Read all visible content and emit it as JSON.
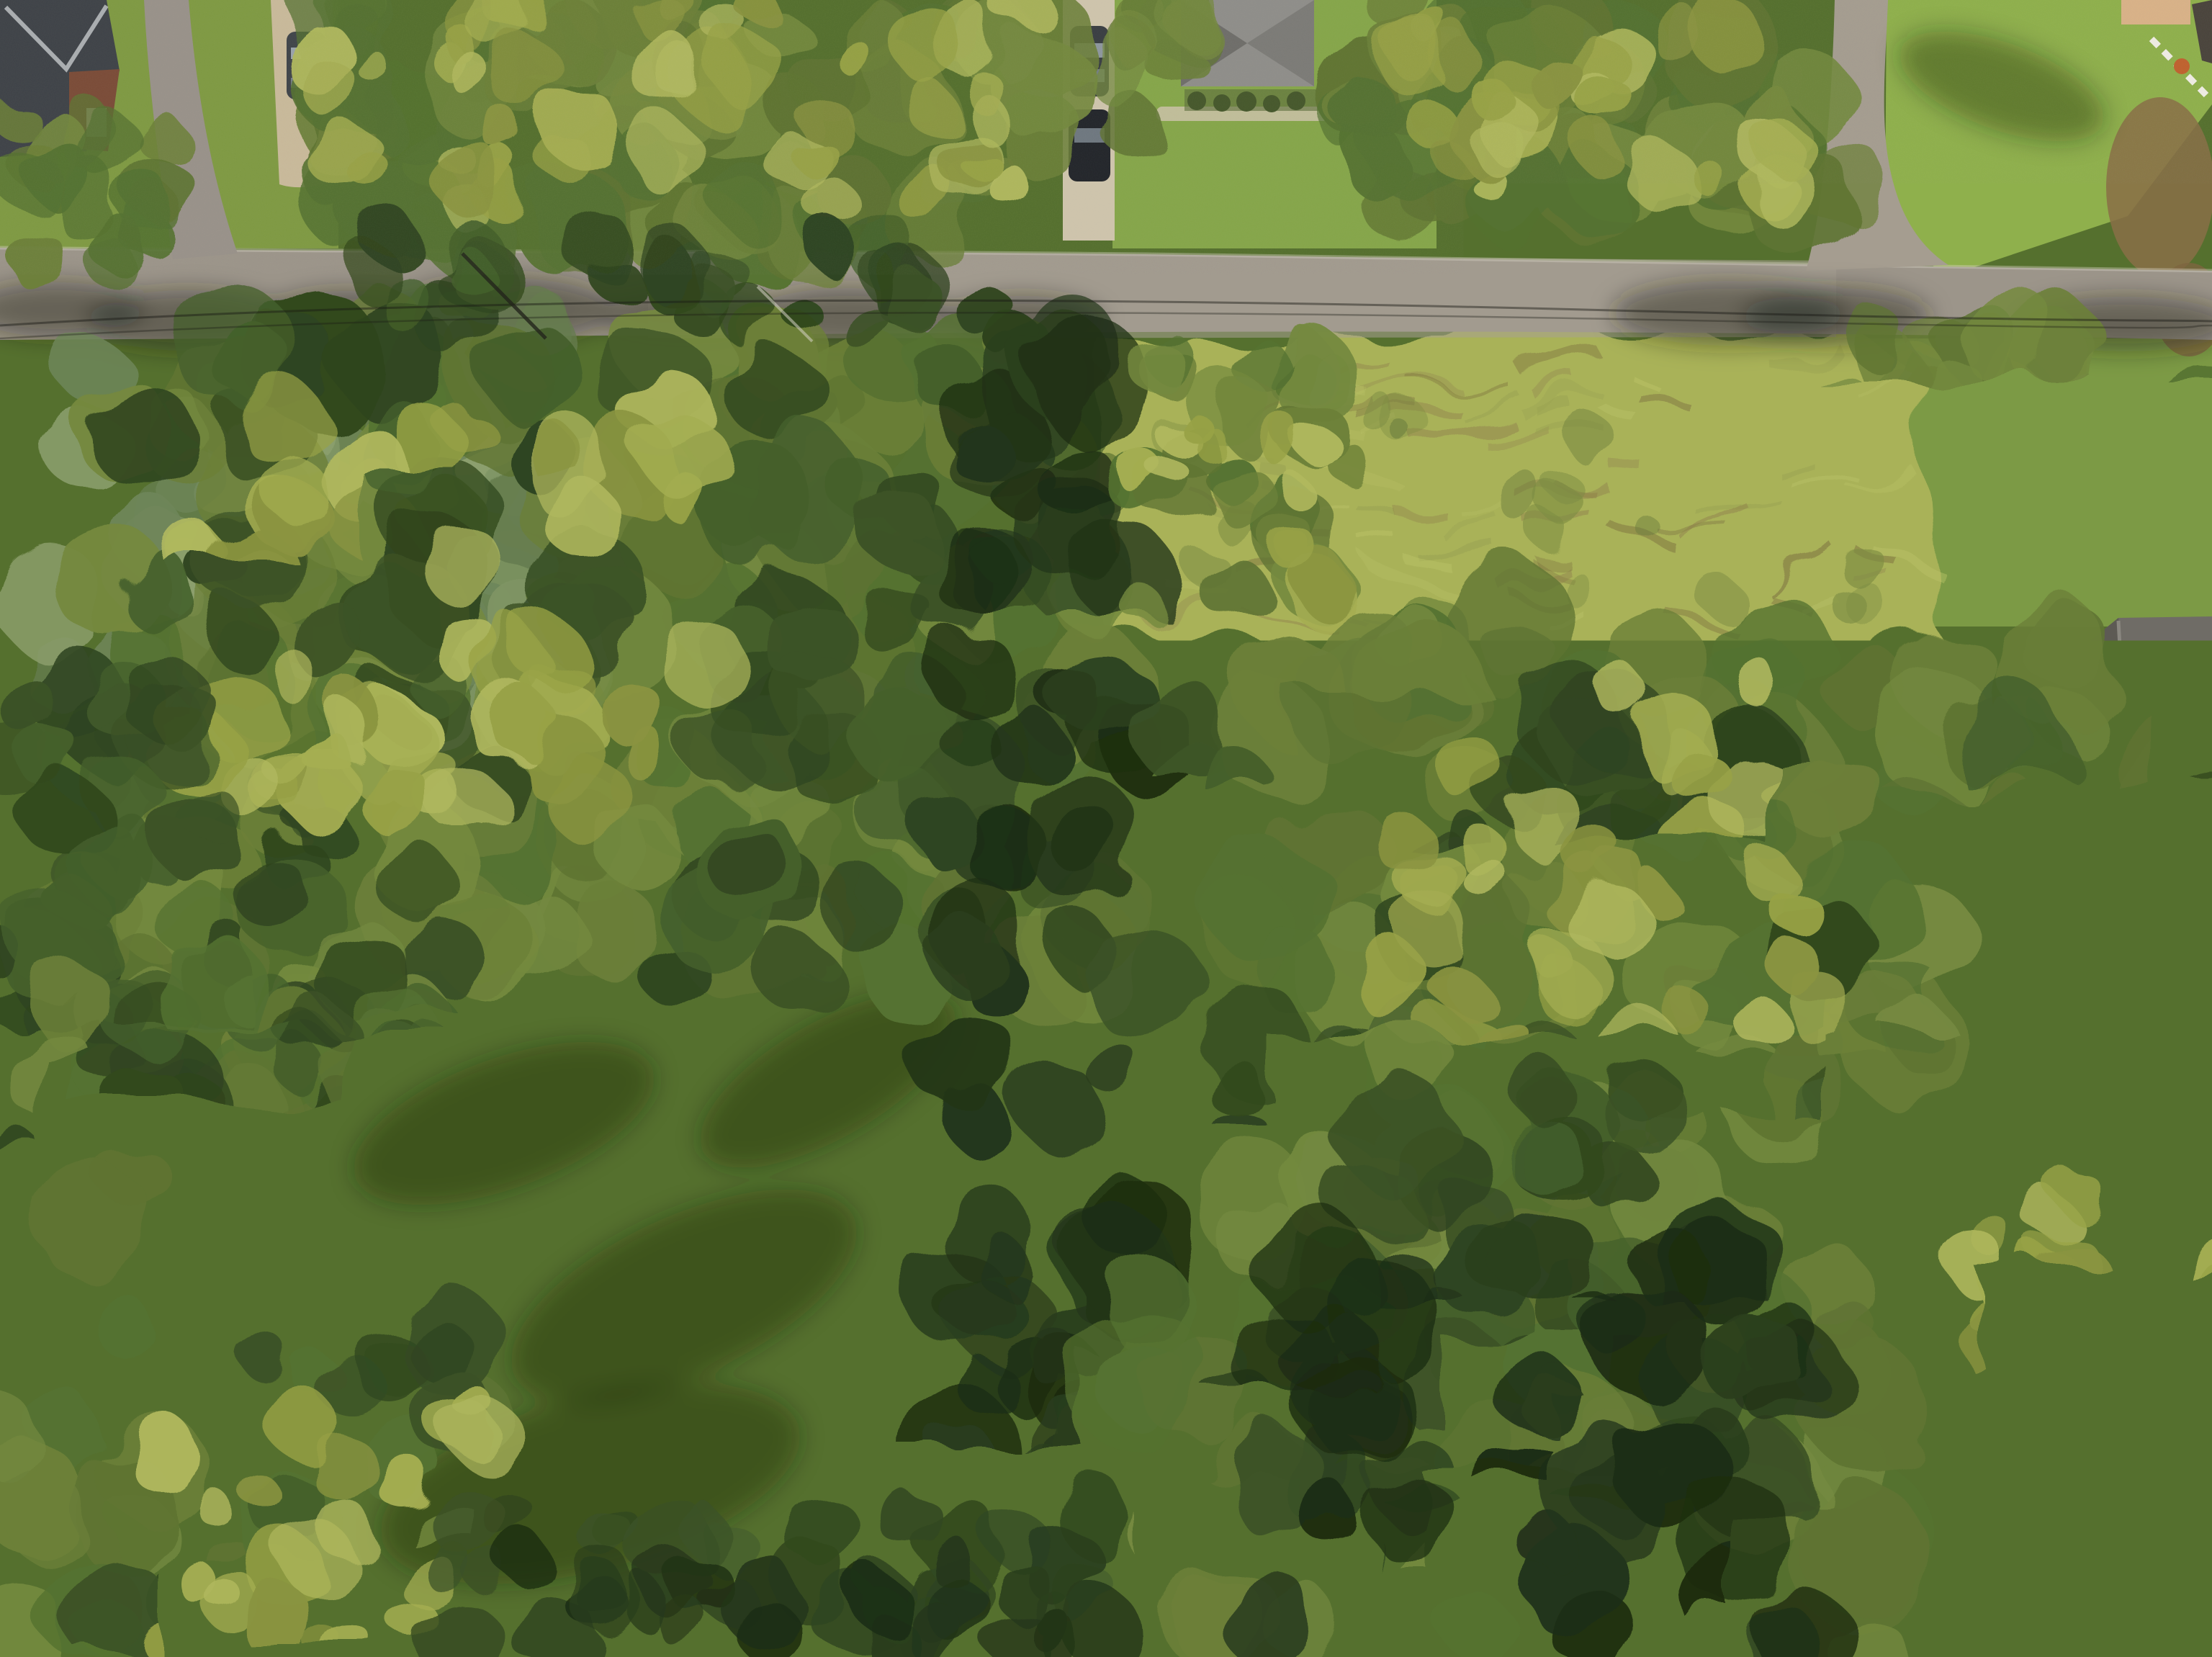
{
  "overlay": {
    "parcel_number": "5260",
    "frontage_label": "150'",
    "side_label": "40'",
    "boundary_color": "#ffffff",
    "label_background": "#ffffff",
    "label_text_color": "#141414"
  },
  "watermark": {
    "icon": "infinity-icon",
    "brand_left": "MIBOR",
    "brand_right": "BLC",
    "color": "#ffffff"
  },
  "palette": {
    "canopy_sunlit": "#98a246",
    "canopy_mid": "#5f7433",
    "canopy_dark": "#3c5226",
    "canopy_shadow": "#24361a",
    "canopy_sage": "#7e9464",
    "meadow": "#a9b259",
    "lawn": "#79a043",
    "road": "#9c958a",
    "gravel": "#c9ba9b",
    "roof_dark": "#43464a",
    "roof_gray": "#8f8e8a",
    "deck_wood": "#c08a52"
  }
}
